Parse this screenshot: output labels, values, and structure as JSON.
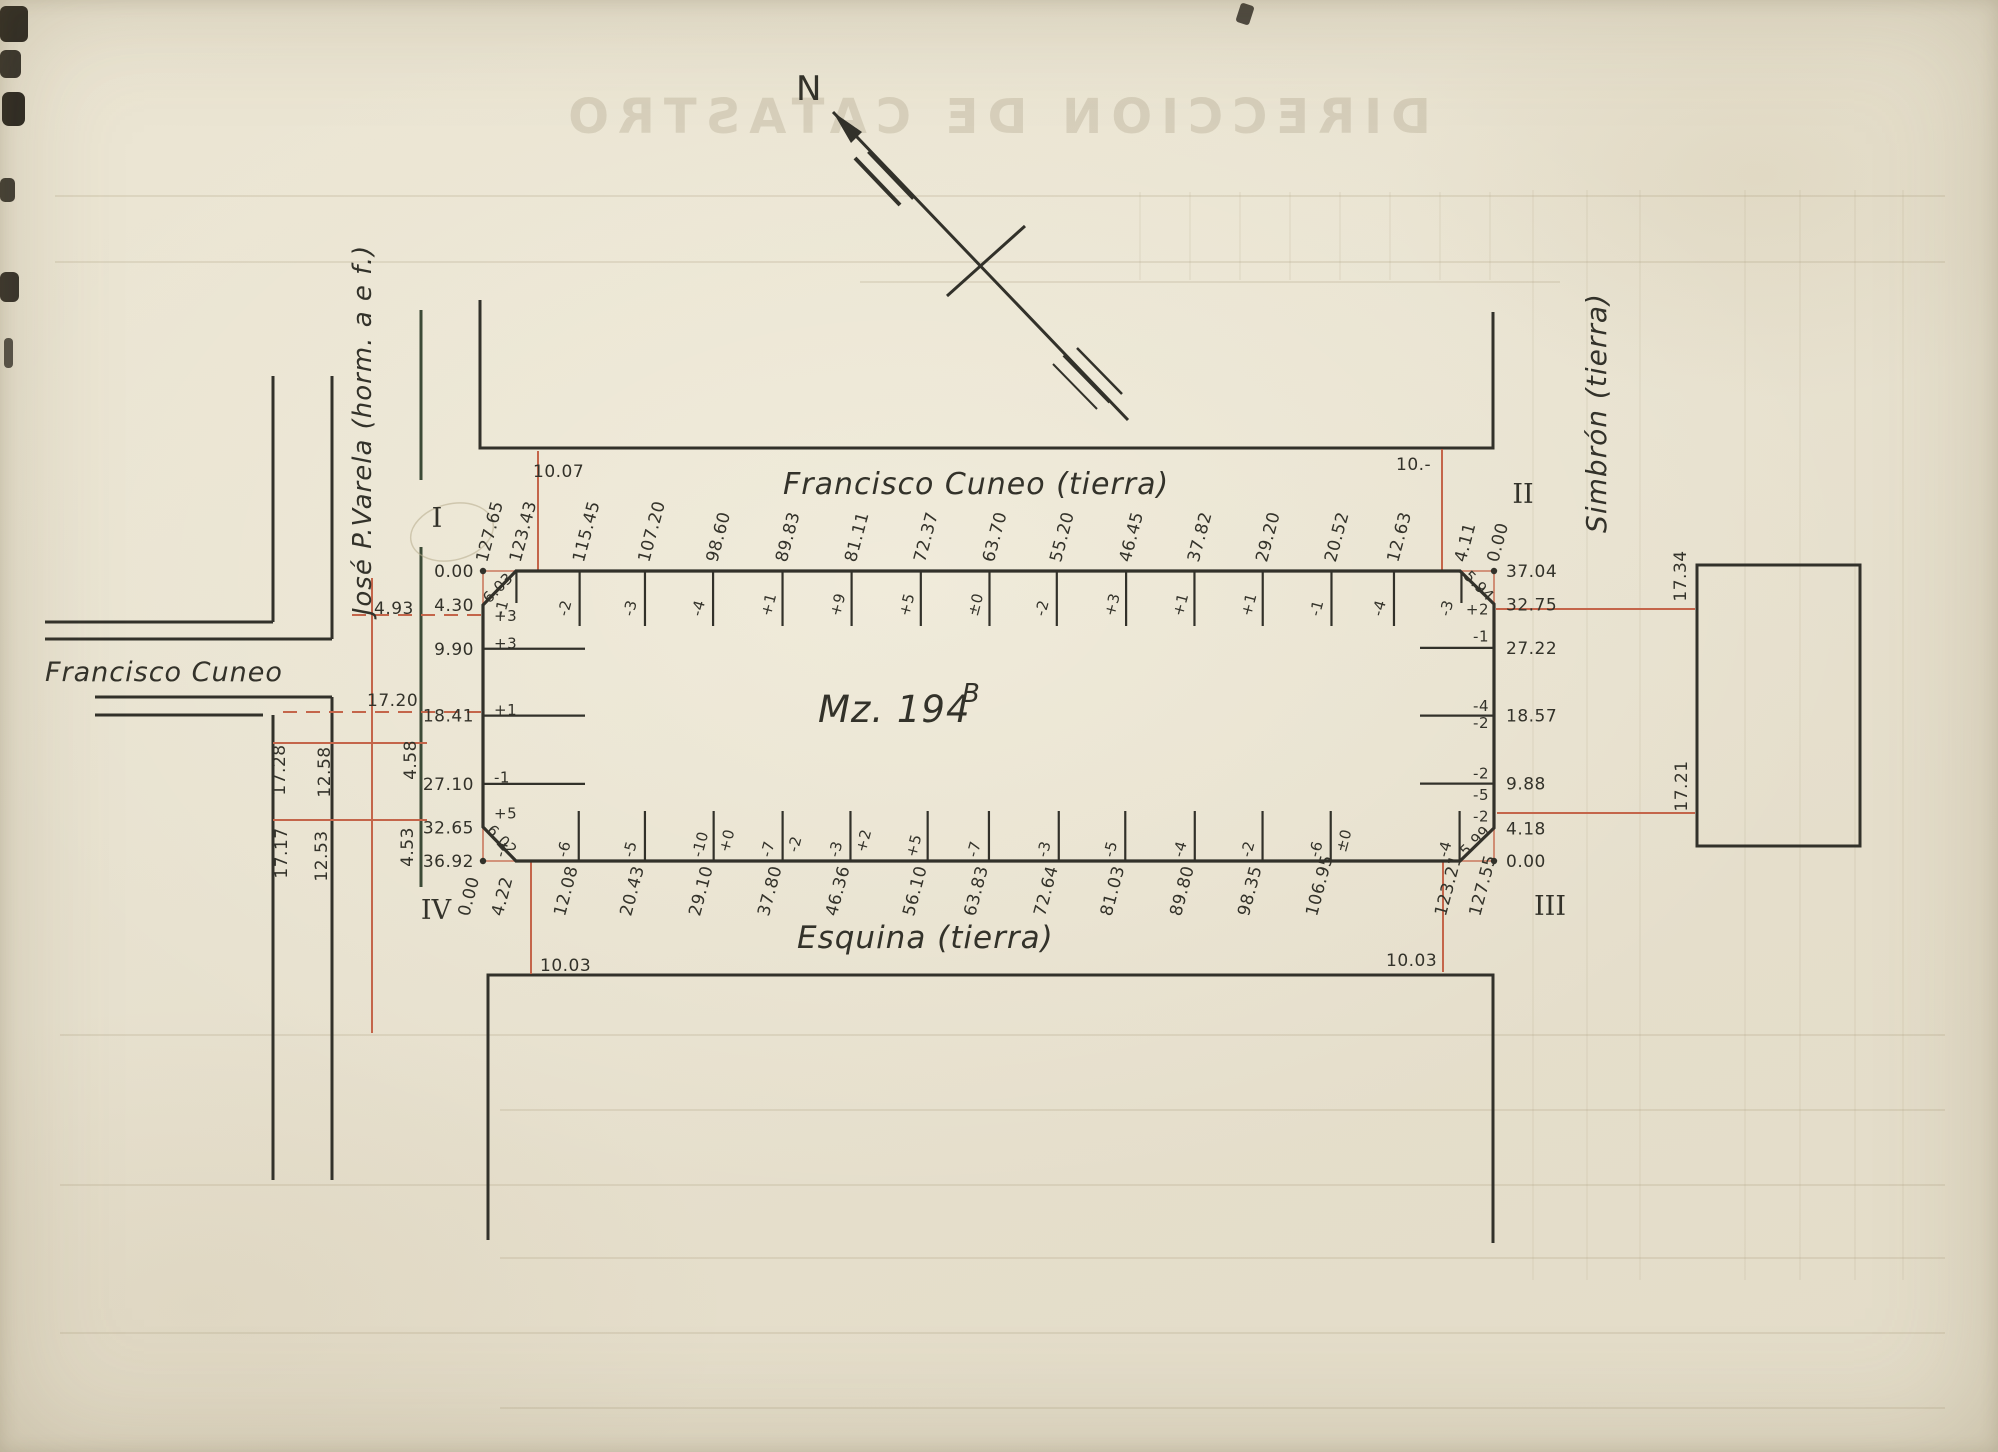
{
  "compass": {
    "north_label": "N"
  },
  "ghost": {
    "title": "DIRECCION DE CATASTRO"
  },
  "block": {
    "name": "Mz. 194",
    "sup": "B"
  },
  "streets": {
    "top": "Francisco Cuneo (tierra)",
    "bottom": "Esquina (tierra)",
    "right": "Simbrón (tierra)",
    "west_ns": "José P.Varela (horm. a e f.)",
    "west_ew": "Francisco Cuneo"
  },
  "corner_numerals": {
    "i": "I",
    "ii": "II",
    "iii": "III",
    "iv": "IV"
  },
  "chamfers": {
    "top_left": "6.03",
    "top_right": "5.94",
    "bottom_right": "5.99",
    "bottom_left": "6.02"
  },
  "connectors": {
    "top_left": "10.07",
    "top_right": "10.-",
    "bottom_left": "10.03",
    "bottom_right": "10.03"
  },
  "side_measures": {
    "w_dash_upper": "4.93",
    "w_dash_lower": "17.20",
    "w_col_a1": "17.28",
    "w_col_b1": "12.58",
    "w_col_a2": "17.17",
    "w_col_b2": "12.53",
    "w_seg_upper": "4.58",
    "w_seg_lower": "4.53",
    "e_upper": "17.34",
    "e_lower": "17.21"
  },
  "top_edge": {
    "ticks": [
      {
        "d": "127.65"
      },
      {
        "d": "123.43",
        "delta": "-1"
      },
      {
        "d": "115.45",
        "delta": "-2"
      },
      {
        "d": "107.20",
        "delta": "-3"
      },
      {
        "d": "98.60",
        "delta": "-4"
      },
      {
        "d": "89.83",
        "delta": "+1"
      },
      {
        "d": "81.11",
        "delta": "+9"
      },
      {
        "d": "72.37",
        "delta": "+5"
      },
      {
        "d": "63.70",
        "delta": "±0"
      },
      {
        "d": "55.20",
        "delta": "-2"
      },
      {
        "d": "46.45",
        "delta": "+3"
      },
      {
        "d": "37.82",
        "delta": "+1"
      },
      {
        "d": "29.20",
        "delta": "+1"
      },
      {
        "d": "20.52",
        "delta": "-1"
      },
      {
        "d": "12.63",
        "delta": "-4"
      },
      {
        "d": "4.11",
        "delta": "-3"
      },
      {
        "d": "0.00"
      }
    ]
  },
  "bottom_edge": {
    "ticks": [
      {
        "d": "0.00"
      },
      {
        "d": "4.22",
        "delta": "-4"
      },
      {
        "d": "12.08",
        "delta": "-6"
      },
      {
        "d": "20.43",
        "delta": "-5"
      },
      {
        "d": "29.10",
        "delta": "-10",
        "delta2": "+0"
      },
      {
        "d": "37.80",
        "delta": "-7",
        "delta2": "-2"
      },
      {
        "d": "46.36",
        "delta": "-3",
        "delta2": "+2"
      },
      {
        "d": "56.10",
        "delta": "+5"
      },
      {
        "d": "63.83",
        "delta": "-7"
      },
      {
        "d": "72.64",
        "delta": "-3"
      },
      {
        "d": "81.03",
        "delta": "-5"
      },
      {
        "d": "89.80",
        "delta": "-4"
      },
      {
        "d": "98.35",
        "delta": "-2"
      },
      {
        "d": "106.95",
        "delta": "-6",
        "delta2": "±0"
      },
      {
        "d": "123.21",
        "delta": "-4"
      },
      {
        "d": "127.55"
      }
    ]
  },
  "left_edge": {
    "ticks": [
      {
        "d": "0.00"
      },
      {
        "d": "4.30"
      },
      {
        "d": "9.90"
      },
      {
        "d": "18.41"
      },
      {
        "d": "27.10"
      },
      {
        "d": "32.65"
      },
      {
        "d": "36.92"
      }
    ],
    "deltas": [
      {
        "t": "+3",
        "m": 5.7
      },
      {
        "t": "+3",
        "m": 9.2
      },
      {
        "t": "+1",
        "m": 17.7
      },
      {
        "t": "-1",
        "m": 26.3
      },
      {
        "t": "+5",
        "m": 30.9
      }
    ]
  },
  "right_edge": {
    "ticks": [
      {
        "d": "37.04"
      },
      {
        "d": "32.75"
      },
      {
        "d": "27.22"
      },
      {
        "d": "18.57"
      },
      {
        "d": "9.88"
      },
      {
        "d": "4.18"
      },
      {
        "d": "0.00"
      }
    ],
    "deltas": [
      {
        "t": "+2",
        "m": 32.1
      },
      {
        "t": "-1",
        "m": 28.7
      },
      {
        "t": "-4",
        "m": 19.8
      },
      {
        "t": "-2",
        "m": 17.6
      },
      {
        "t": "-2",
        "m": 11.2
      },
      {
        "t": "-5",
        "m": 8.4
      },
      {
        "t": "-2",
        "m": 5.7
      }
    ]
  }
}
